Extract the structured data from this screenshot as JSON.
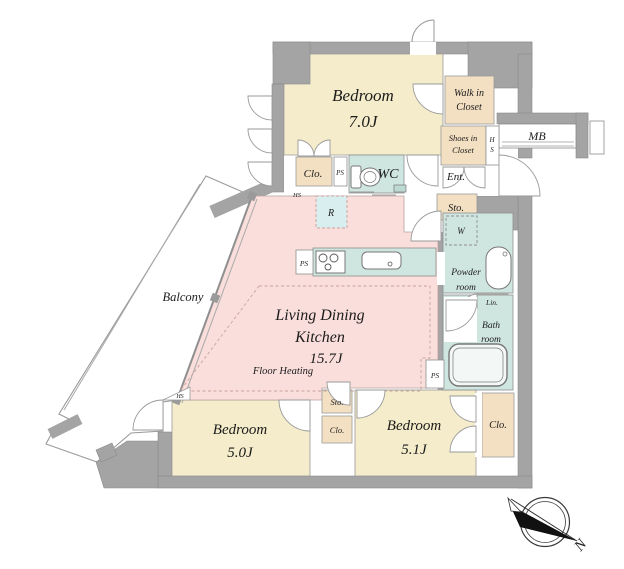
{
  "plan": {
    "bedroom1": {
      "name": "Bedroom",
      "size": "7.0J"
    },
    "bedroom2": {
      "name": "Bedroom",
      "size": "5.0J"
    },
    "bedroom3": {
      "name": "Bedroom",
      "size": "5.1J"
    },
    "ldk": {
      "line1": "Living Dining",
      "line2": "Kitchen",
      "size": "15.7J",
      "floor_heating": "Floor Heating"
    },
    "balcony": "Balcony",
    "walk_in_closet": {
      "line1": "Walk in",
      "line2": "Closet"
    },
    "shoes_in_closet": {
      "line1": "Shoes in",
      "line2": "Closet"
    },
    "powder_room": {
      "line1": "Powder",
      "line2": "room"
    },
    "bath_room": {
      "line1": "Bath",
      "line2": "room"
    },
    "labels": {
      "wc": "WC",
      "ent": "Ent.",
      "mb": "MB",
      "lin": "Lin.",
      "washer": "W",
      "fridge": "R",
      "sto_entrance": "Sto.",
      "sto_hall": "Sto.",
      "clo_bedroom1": "Clo.",
      "clo_hall": "Clo.",
      "clo_bedroom3": "Clo.",
      "ps_wc": "PS",
      "ps_kitchen": "PS",
      "ps_bath": "PS",
      "hs_wc": "HS",
      "hs_bedroom2": "HS",
      "hs_shoes_h": "H",
      "hs_shoes_s": "S",
      "north": "N"
    },
    "colors": {
      "wall": "#a4a4a4",
      "bedroom_fill": "#f4ecca",
      "closet_fill": "#f3dfc2",
      "ldk_fill": "#f9dedb",
      "wet_area_fill": "#cfe5df",
      "fridge_fill": "#d9eeee"
    }
  }
}
